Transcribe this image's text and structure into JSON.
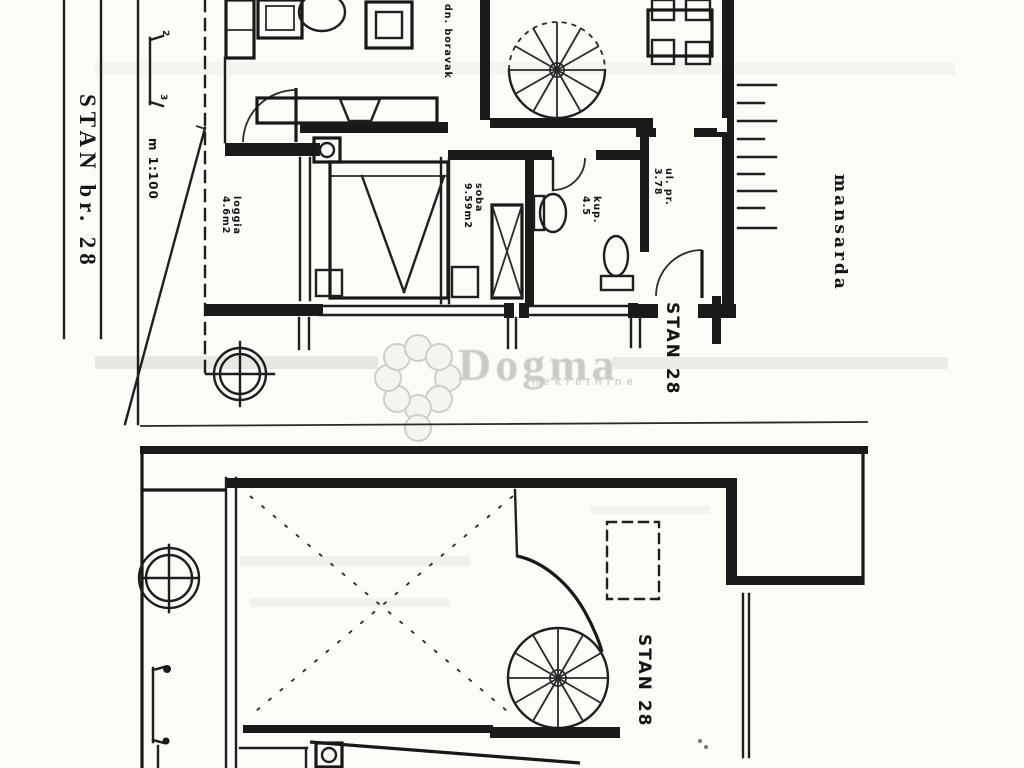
{
  "side": {
    "stan_label": "STAN br. 28",
    "scale": "m 1:100",
    "dim_top": "2",
    "dim_bottom": "3"
  },
  "top_plan": {
    "loggia_name": "loggia",
    "loggia_area": "4.6m2",
    "living_label": "dn. boravak",
    "soba_name": "soba",
    "soba_area": "9.59m2",
    "kup_name": "kup.",
    "kup_area": "4.5",
    "ulpr_name": "ul. pr.",
    "ulpr_area": "3.78",
    "stan_label": "STAN 28",
    "floor_label": "mansarda"
  },
  "bottom_plan": {
    "stan_label": "STAN 28"
  },
  "watermark": {
    "brand": "Dogma",
    "subtitle": "nekretnine"
  },
  "colors": {
    "ink": "#1b1b1b",
    "paper": "#fbfbf8",
    "watermark_gray": "#c9cbc6"
  }
}
